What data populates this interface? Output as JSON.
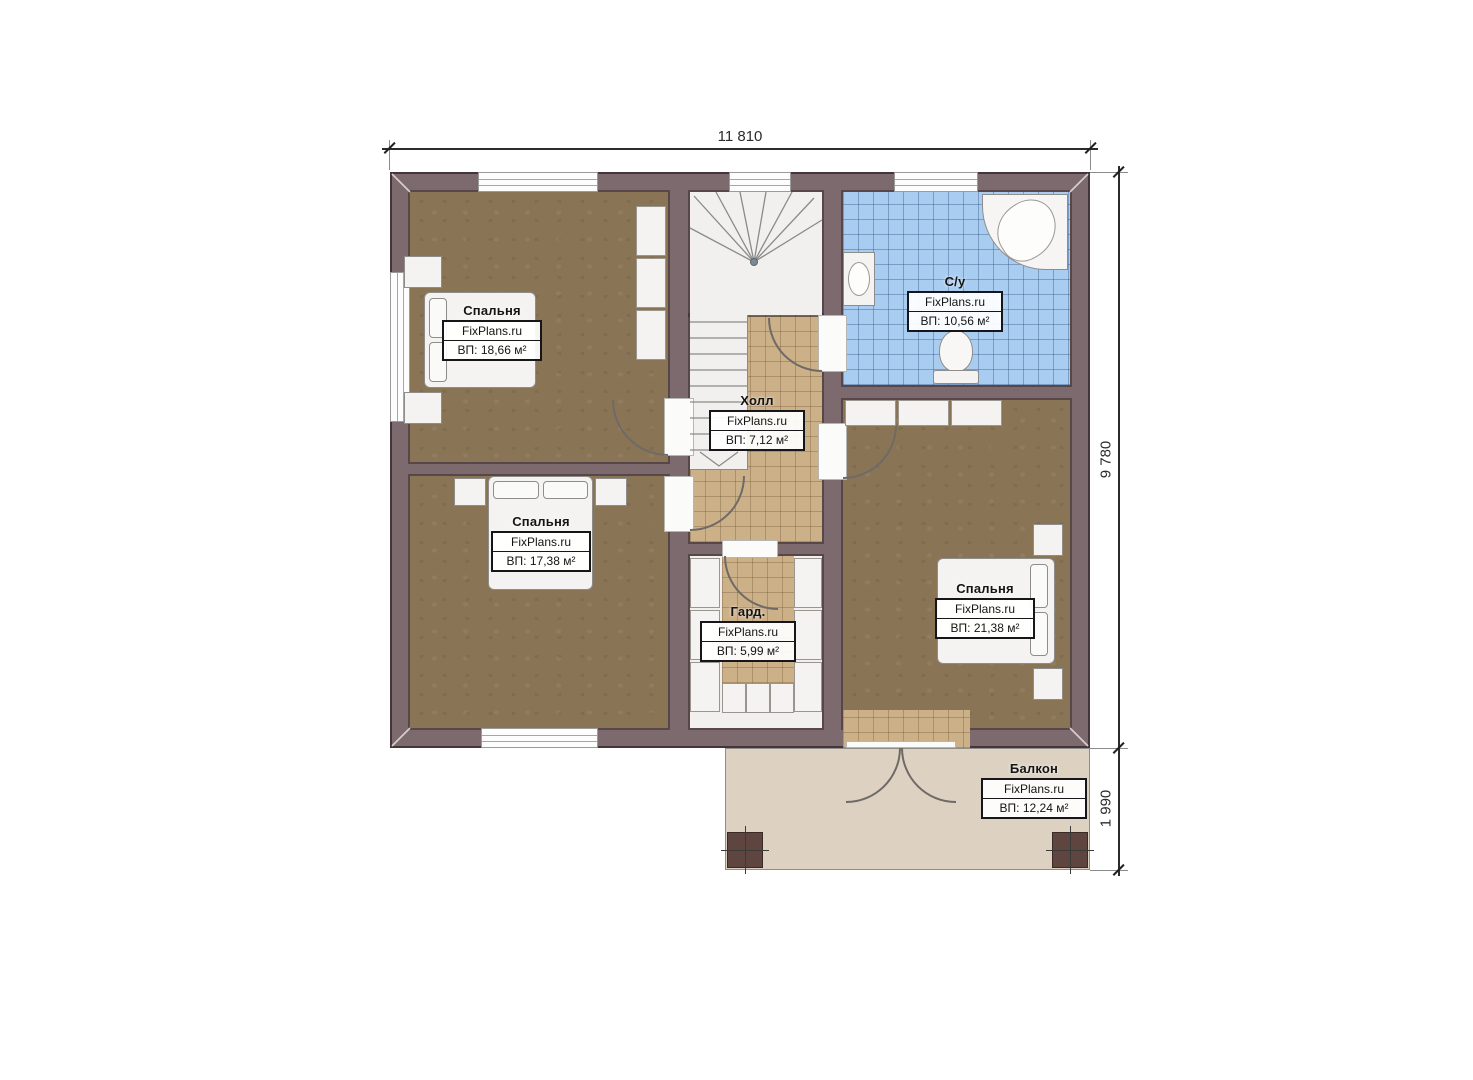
{
  "watermark": "FixPlans.ru",
  "dimensions": {
    "top": "11 810",
    "right_main": "9 780",
    "right_balcony": "1 990"
  },
  "rooms": {
    "bedroom1": {
      "name": "Спальня",
      "area": "ВП: 18,66 м²"
    },
    "bedroom2": {
      "name": "Спальня",
      "area": "ВП: 17,38 м²"
    },
    "bedroom3": {
      "name": "Спальня",
      "area": "ВП: 21,38 м²"
    },
    "bathroom": {
      "name": "С/у",
      "area": "ВП: 10,56 м²"
    },
    "hall": {
      "name": "Холл",
      "area": "ВП: 7,12 м²"
    },
    "wardrobe": {
      "name": "Гард.",
      "area": "ВП: 5,99 м²"
    },
    "balcony": {
      "name": "Балкон",
      "area": "ВП: 12,24 м²"
    }
  },
  "colors": {
    "wall": "#7d6a6e",
    "bedroom_floor": "#8a7456",
    "tile_beige": "#ccb088",
    "tile_blue": "#a9cdf1",
    "balcony_floor": "#ddd2c2",
    "column": "#5e4540"
  }
}
